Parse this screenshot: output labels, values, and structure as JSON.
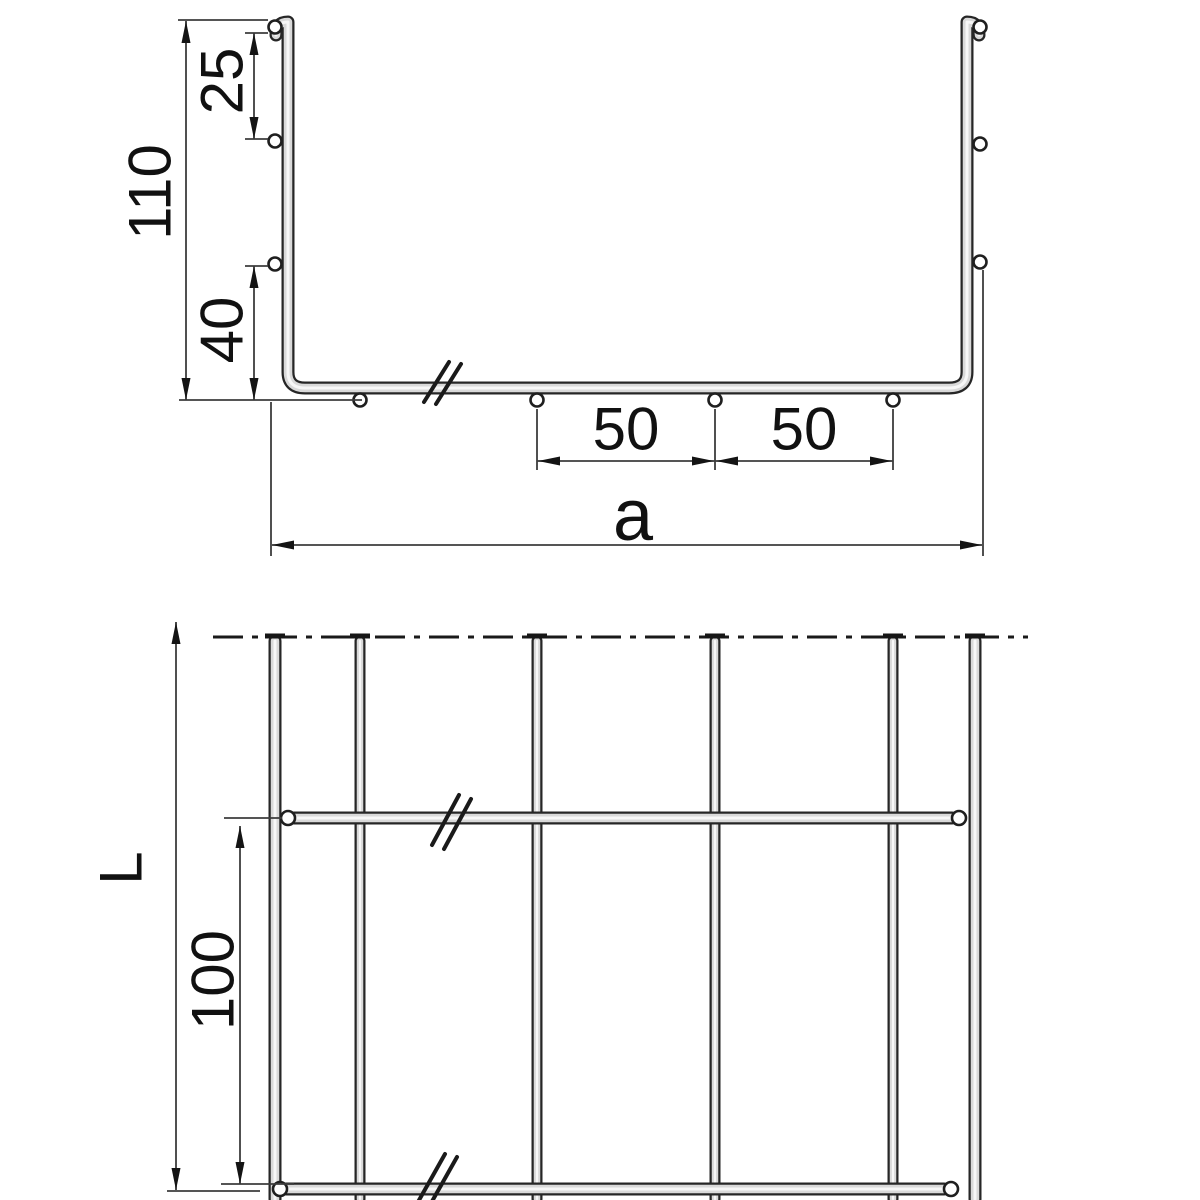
{
  "labels": {
    "cross_section": {
      "total_height": "110",
      "top_wire_offset": "25",
      "bottom_wire_offset": "40",
      "wire_spacing_left": "50",
      "wire_spacing_right": "50",
      "overall_width": "a"
    },
    "plan_view": {
      "tray_length": "L",
      "cross_wire_pitch": "100"
    }
  }
}
